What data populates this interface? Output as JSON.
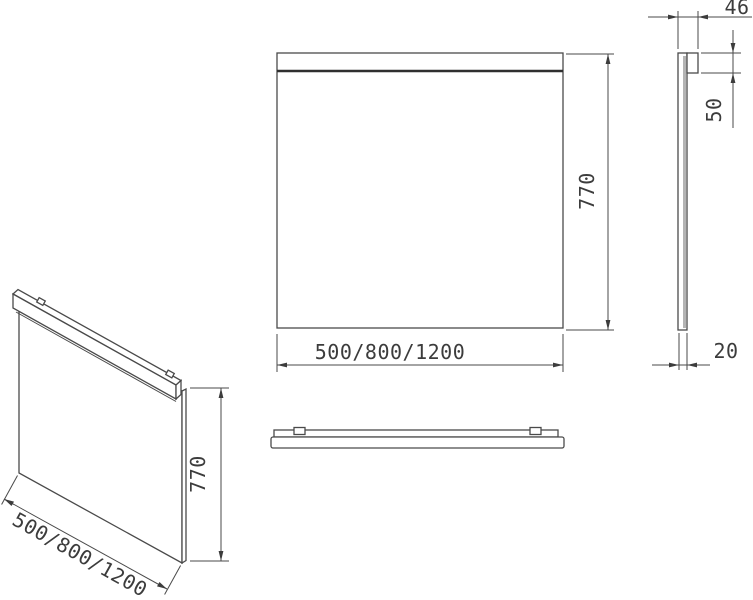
{
  "drawing": {
    "description": "Mirror with top mounting rail - orthographic and isometric technical views",
    "front_view": {
      "height": "770",
      "width_options": "500/800/1200"
    },
    "side_view": {
      "total_depth": "46",
      "rail_height": "50",
      "mirror_thickness": "20"
    },
    "iso_view": {
      "height": "770",
      "width_options": "500/800/1200"
    },
    "colors": {
      "line": "#4a4a4a",
      "thick_line": "#2f2f2f",
      "text": "#3c3c3c",
      "glass_edge": "#b4b4b4",
      "background": "#ffffff"
    }
  }
}
